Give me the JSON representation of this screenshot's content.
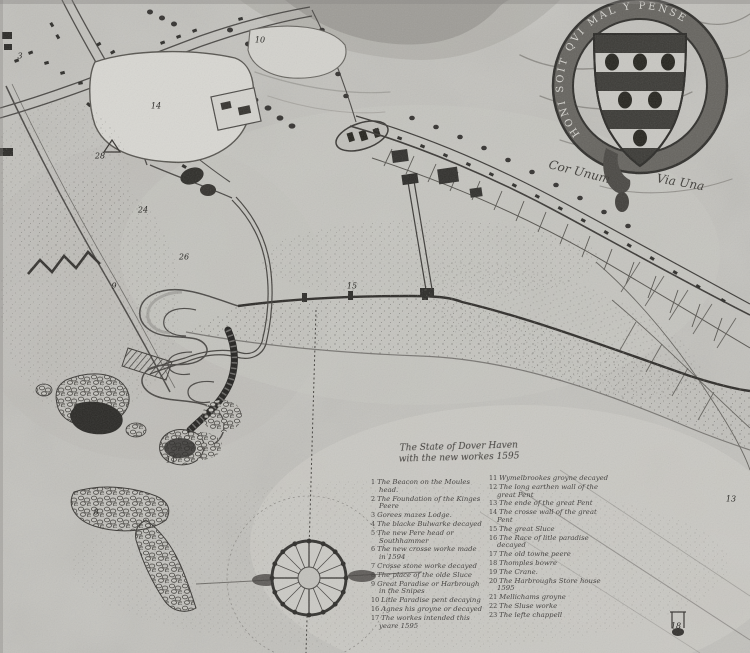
{
  "title": {
    "line1": "The State of Dover Haven",
    "line2": "with the new workes 1595"
  },
  "legend": {
    "left_column": [
      {
        "num": "1",
        "text": "The Beacon on the Moules head."
      },
      {
        "num": "2",
        "text": "The Foundation of the Kinges Peere"
      },
      {
        "num": "3",
        "text": "Gorees mazes Lodge."
      },
      {
        "num": "4",
        "text": "The blacke Bulwarke decayed"
      },
      {
        "num": "5",
        "text": "The new Pere head or Southhammer"
      },
      {
        "num": "6",
        "text": "The new crosse worke made in 1594"
      },
      {
        "num": "7",
        "text": "Crosse stone worke decayed"
      },
      {
        "num": "8",
        "text": "The place of the olde Sluce"
      },
      {
        "num": "9",
        "text": "Great Paradise or Harbrough in the Snipes"
      },
      {
        "num": "10",
        "text": "Litle Paradise pent decaying"
      },
      {
        "num": "16",
        "text": "Agnes his groyne or decayed"
      },
      {
        "num": "17",
        "text": "The workes intended this yeare 1595"
      }
    ],
    "right_column": [
      {
        "num": "11",
        "text": "Wymelbrookes groyne decayed"
      },
      {
        "num": "12",
        "text": "The long earthen wall of the great Pent"
      },
      {
        "num": "13",
        "text": "The ende of the great Pent"
      },
      {
        "num": "14",
        "text": "The crosse wall of the great Pent"
      },
      {
        "num": "15",
        "text": "The great Sluce"
      },
      {
        "num": "16",
        "text": "The Race of litle paradise decayed"
      },
      {
        "num": "17",
        "text": "The old towne peere"
      },
      {
        "num": "18",
        "text": "Thomples bowre"
      },
      {
        "num": "19",
        "text": "The Crane."
      },
      {
        "num": "20",
        "text": "The Harbroughs Store house 1595"
      },
      {
        "num": "21",
        "text": "Mellichams groyne"
      },
      {
        "num": "22",
        "text": "The Sluse worke"
      },
      {
        "num": "23",
        "text": "The lefte chappell"
      }
    ]
  },
  "coat_of_arms": {
    "garter_motto": "HONI SOIT QVI MAL Y PENSE",
    "motto_left": "Cor Unum",
    "motto_right": "Via Una"
  },
  "map_labels": [
    {
      "text": "3",
      "x": 20,
      "y": 56
    },
    {
      "text": "28",
      "x": 100,
      "y": 156
    },
    {
      "text": "24",
      "x": 143,
      "y": 210
    },
    {
      "text": "26",
      "x": 184,
      "y": 257
    },
    {
      "text": "9",
      "x": 114,
      "y": 286
    },
    {
      "text": "14",
      "x": 156,
      "y": 106
    },
    {
      "text": "10",
      "x": 260,
      "y": 40
    },
    {
      "text": "15",
      "x": 352,
      "y": 286
    },
    {
      "text": "11",
      "x": 171,
      "y": 460
    },
    {
      "text": "8",
      "x": 96,
      "y": 512
    },
    {
      "text": "13",
      "x": 731,
      "y": 499
    },
    {
      "text": "18",
      "x": 676,
      "y": 626
    }
  ],
  "colors": {
    "paper": "#c2c1bc",
    "ink": "#3a3835",
    "dark_feature": "#2a2926"
  }
}
